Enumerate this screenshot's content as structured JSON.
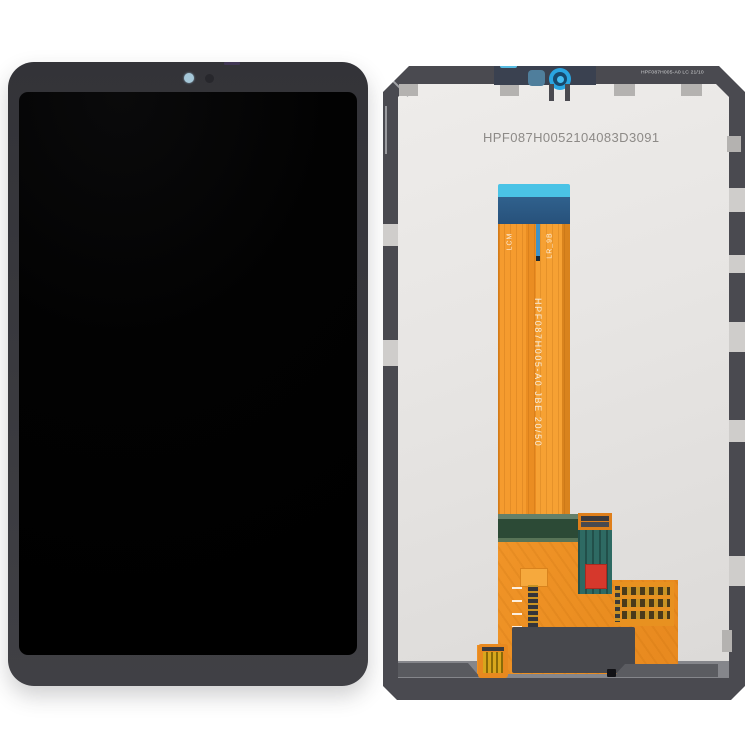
{
  "product_photo": {
    "description_visible_text_only": true,
    "front_view": {
      "screen_state": "off",
      "camera": "front-camera-dot"
    },
    "back_view": {
      "serial_number": "HPF087H0052104083D3091",
      "spec_label": "HPF087H005-A0 LC 21/10",
      "flex": {
        "part_number": "HPF087H005-A0  JBE 20/50",
        "ribbon_left_label": "LCM",
        "ribbon_right_label": "LR_9B"
      }
    },
    "colors": {
      "background": "#ffffff",
      "bezel_gray": "#3a3a3f",
      "panel_frame": "#4a4a50",
      "panel_interior": "#e7e5e3",
      "flex_orange": "#f09428",
      "connector_blue": "#2aa5e1",
      "connector_cyan": "#4ac3e6",
      "pcb_green": "#2c4a36",
      "driver_teal": "#2e6a63",
      "component_red": "#d6382c",
      "gold_contacts": "#d8a61c"
    }
  }
}
